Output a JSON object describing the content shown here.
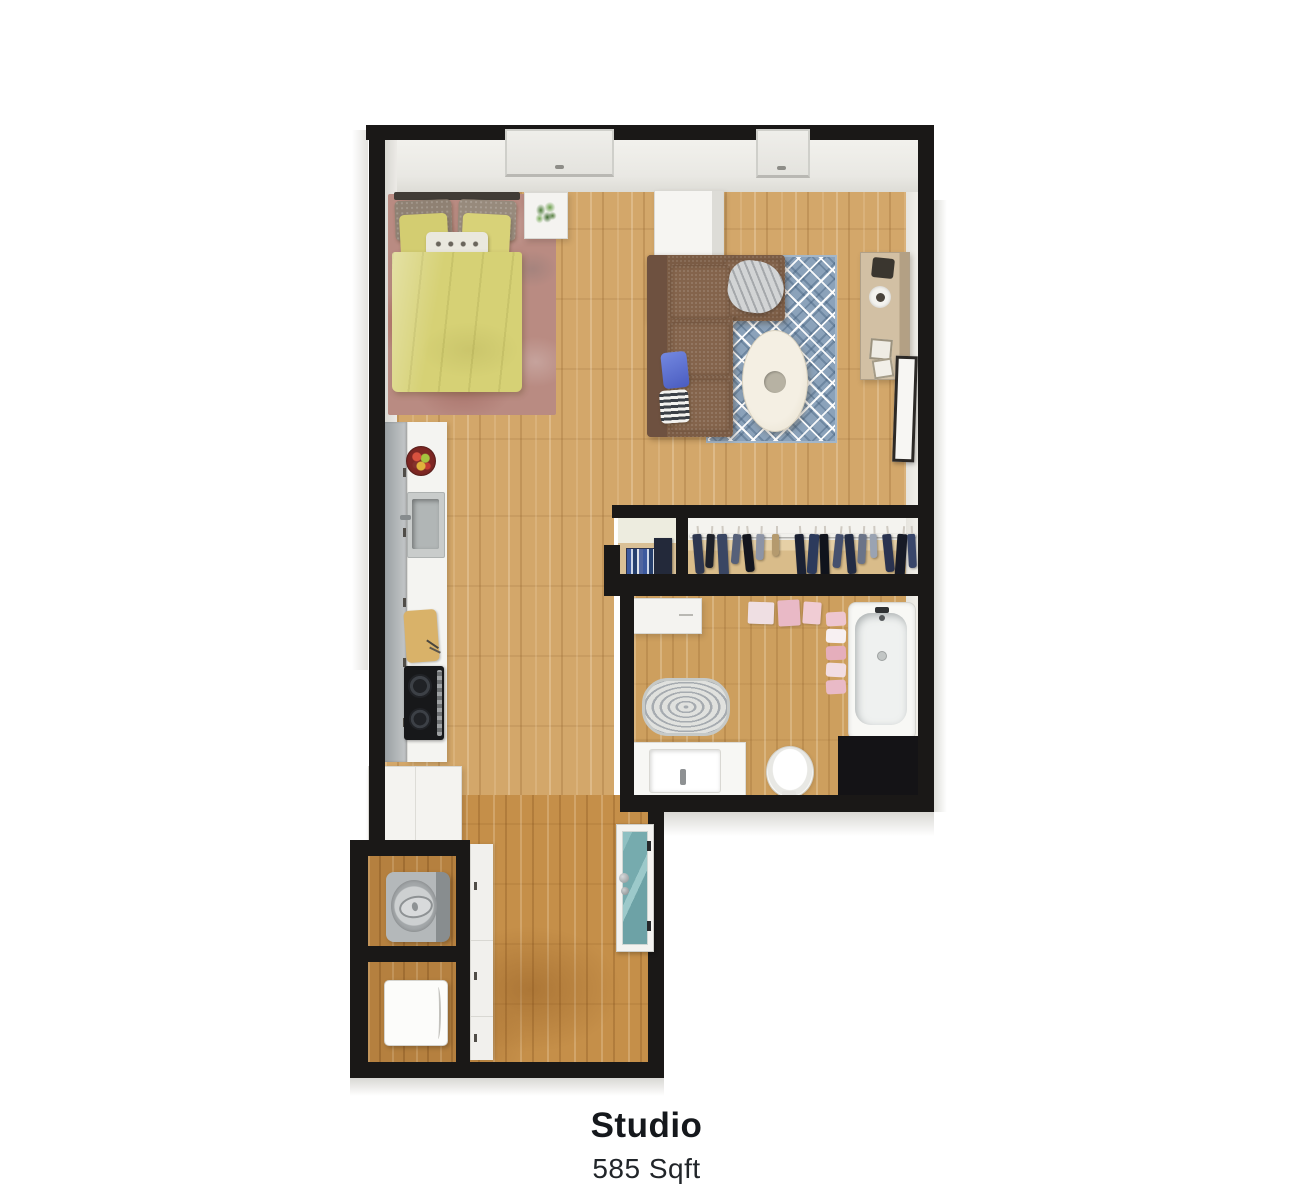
{
  "caption": {
    "title": "Studio",
    "area": "585 Sqft"
  },
  "colors": {
    "wall": "#1a1817",
    "floor_wood": "#d3a76a",
    "hallway_wood": "#c58f49",
    "bedroom_rug": "#b98b82",
    "bed_duvet": "#d6d175",
    "sofa_brown": "#7b5c45",
    "living_rug_blue": "#8ba2ba",
    "kitchen_counter": "#f4f4f1",
    "cooktop_black": "#17181a",
    "towel_pink": "#e9b9c6",
    "entry_door_glass": "#7fb2b5"
  },
  "closet": {
    "garments": [
      {
        "x": 6,
        "w": 9,
        "h": 40,
        "c": "#2e3750",
        "r": -5
      },
      {
        "x": 18,
        "w": 8,
        "h": 34,
        "c": "#1d2029",
        "r": 3
      },
      {
        "x": 30,
        "w": 10,
        "h": 42,
        "c": "#3a4663",
        "r": -3
      },
      {
        "x": 44,
        "w": 8,
        "h": 30,
        "c": "#566079",
        "r": 5
      },
      {
        "x": 56,
        "w": 9,
        "h": 38,
        "c": "#14161e",
        "r": -6
      },
      {
        "x": 68,
        "w": 8,
        "h": 26,
        "c": "#8d94a5",
        "r": 2
      },
      {
        "x": 84,
        "w": 7,
        "h": 22,
        "c": "#b49a6e",
        "r": 0
      },
      {
        "x": 108,
        "w": 9,
        "h": 44,
        "c": "#1b2133",
        "r": -4
      },
      {
        "x": 120,
        "w": 10,
        "h": 40,
        "c": "#2c3a5c",
        "r": 4
      },
      {
        "x": 132,
        "w": 9,
        "h": 46,
        "c": "#10131c",
        "r": -2
      },
      {
        "x": 146,
        "w": 8,
        "h": 34,
        "c": "#45506e",
        "r": 6
      },
      {
        "x": 158,
        "w": 9,
        "h": 40,
        "c": "#232c44",
        "r": -5
      },
      {
        "x": 170,
        "w": 8,
        "h": 30,
        "c": "#6b7488",
        "r": 3
      },
      {
        "x": 182,
        "w": 7,
        "h": 24,
        "c": "#9aa3b2",
        "r": -2
      },
      {
        "x": 196,
        "w": 9,
        "h": 38,
        "c": "#2a3350",
        "r": -6
      },
      {
        "x": 208,
        "w": 10,
        "h": 44,
        "c": "#171a26",
        "r": 4
      },
      {
        "x": 220,
        "w": 8,
        "h": 34,
        "c": "#39466a",
        "r": -3
      }
    ]
  }
}
